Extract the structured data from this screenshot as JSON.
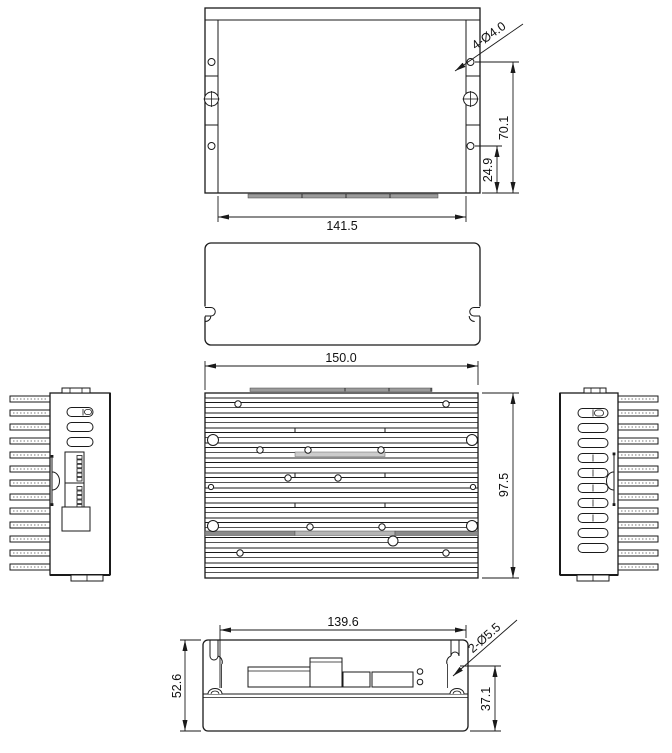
{
  "views": {
    "top": {
      "dim_width": "141.5",
      "dim_height_right": "70.1",
      "dim_offset_right": "24.9",
      "callout_holes": "4-Ø4.0"
    },
    "front": {
      "dim_width": "150.0",
      "dim_height_right": "97.5"
    },
    "bottom": {
      "dim_width_top": "139.6",
      "dim_height_left": "52.6",
      "dim_height_right": "37.1",
      "callout_holes": "2-Ø5.5"
    }
  },
  "colors": {
    "line": "#1a1a1a",
    "text": "#111111",
    "connector_strip": "#9b9b9b",
    "fin_dark": "#8a8a8a",
    "fin_mid": "#b5b5b5"
  }
}
